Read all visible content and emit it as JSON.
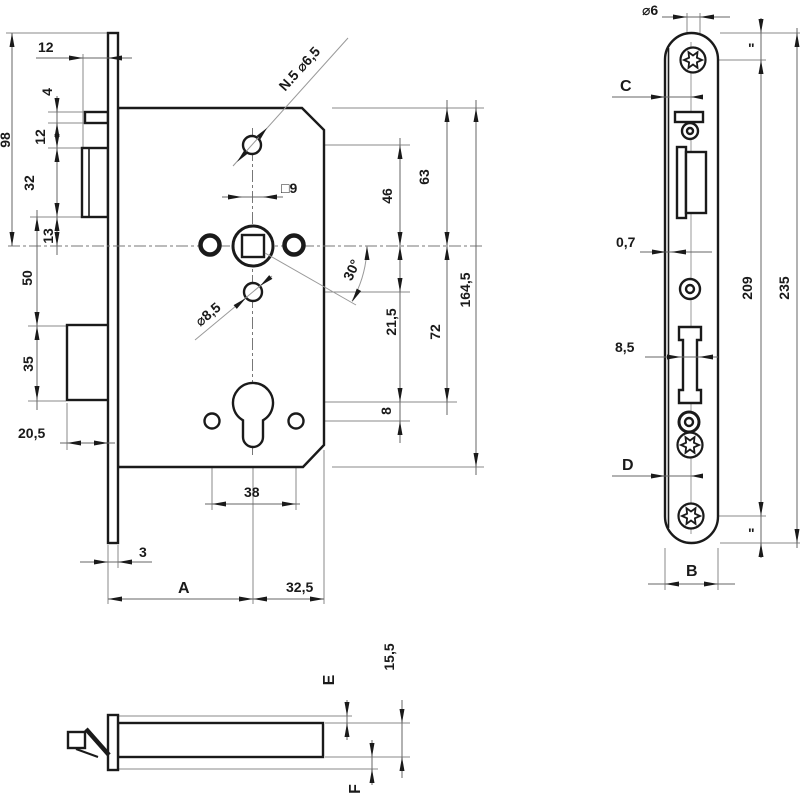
{
  "main_view": {
    "dims": {
      "latch_protrusion": "12",
      "aux_latch_height": "4",
      "aux_to_latch": "12",
      "latch_height": "32",
      "latch_to_center": "13",
      "latch_to_bolt": "50",
      "bolt_height": "35",
      "bolt_protrusion": "20,5",
      "plate_top_to_center": "98",
      "plate_thickness": "3",
      "backset": "A",
      "center_to_back": "32,5",
      "cyl_screw_spacing": "38",
      "cyl_hole_offset": "8",
      "center_to_hole": "21,5",
      "center_to_cylinder": "72",
      "hole_to_center": "46",
      "top_to_center": "63",
      "case_height": "164,5"
    },
    "labels": {
      "angle": "30°",
      "spindle_square": "□9",
      "top_hole_note": "N.5 ⌀6,5",
      "mid_hole_note": "⌀8,5"
    }
  },
  "faceplate_view": {
    "dims": {
      "screw_diameter": "⌀6",
      "edge_to_center_top": "C",
      "plate_offset": "0,7",
      "bolt_slot_width": "8,5",
      "screw_spacing": "209",
      "plate_length": "235",
      "edge_to_center_bottom": "D",
      "plate_width": "B",
      "end_to_screw_top": "\"",
      "end_to_screw_bottom": "\""
    }
  },
  "side_view": {
    "dims": {
      "case_offset_top": "E",
      "case_depth": "15,5",
      "case_offset_bottom": "F"
    }
  }
}
